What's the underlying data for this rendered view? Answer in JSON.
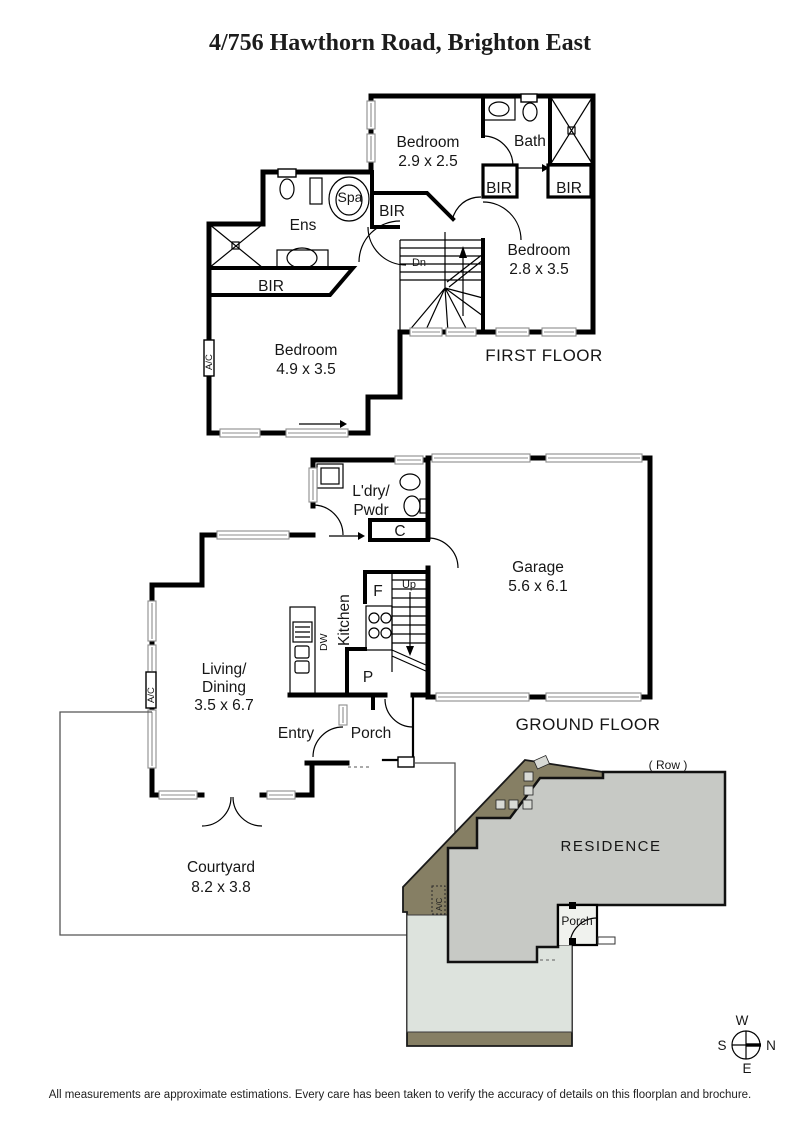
{
  "title": "4/756 Hawthorn Road, Brighton East",
  "first_floor": {
    "floor_label": "FIRST FLOOR",
    "bedroom1_name": "Bedroom",
    "bedroom1_dims": "2.9 x 2.5",
    "bath": "Bath",
    "bir_left": "BIR",
    "bir_right": "BIR",
    "bir_hall": "BIR",
    "bir_ens": "BIR",
    "ens": "Ens",
    "spa": "Spa",
    "stairs_dn": "Dn",
    "bedroom2_name": "Bedroom",
    "bedroom2_dims": "2.8 x 3.5",
    "bedroom3_name": "Bedroom",
    "bedroom3_dims": "4.9 x 3.5",
    "ac": "A/C"
  },
  "ground_floor": {
    "floor_label": "GROUND FLOOR",
    "laundry_line1": "L'dry/",
    "laundry_line2": "Pwdr",
    "cupboard": "C",
    "garage_name": "Garage",
    "garage_dims": "5.6 x 6.1",
    "kitchen": "Kitchen",
    "fridge": "F",
    "dishwasher": "DW",
    "pantry": "P",
    "stairs_up": "Up",
    "living_line1": "Living/",
    "living_line2": "Dining",
    "living_dims": "3.5 x 6.7",
    "entry": "Entry",
    "porch": "Porch",
    "ac": "A/C",
    "courtyard_name": "Courtyard",
    "courtyard_dims": "8.2 x 3.8"
  },
  "site_plan": {
    "row_label": "( Row )",
    "residence_label": "RESIDENCE",
    "porch_label": "Porch",
    "ac_label": "A/C",
    "colors": {
      "ground": "#867f64",
      "residence": "#c7c9c5",
      "courtyard": "#dde3dd"
    }
  },
  "compass": {
    "n": "N",
    "s": "S",
    "e": "E",
    "w": "W"
  },
  "disclaimer": "All measurements are approximate estimations. Every care has been taken to verify the accuracy of details on this floorplan and brochure."
}
